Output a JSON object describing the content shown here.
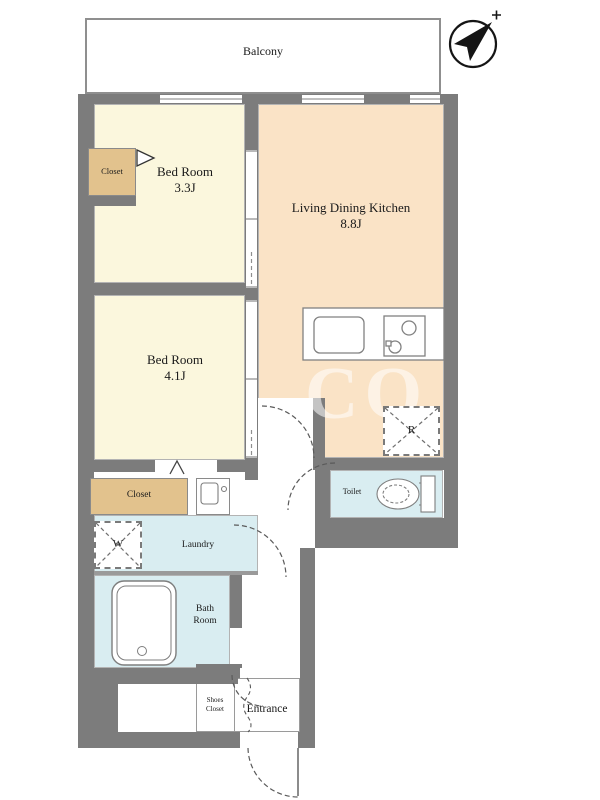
{
  "balcony": {
    "label": "Balcony"
  },
  "compass": {
    "meaning": "north-arrow pointing upper-right"
  },
  "rooms": {
    "bedroom1": {
      "name": "Bed Room",
      "size": "3.3J"
    },
    "ldk": {
      "name": "Living Dining Kitchen",
      "size": "8.8J"
    },
    "bedroom2": {
      "name": "Bed Room",
      "size": "4.1J"
    },
    "closet1": {
      "label": "Closet"
    },
    "closet2": {
      "label": "Closet"
    },
    "laundry": {
      "label": "Laundry"
    },
    "toilet": {
      "label": "Toilet"
    },
    "bathroom": {
      "line1": "Bath",
      "line2": "Room"
    },
    "shoes_closet": {
      "line1": "Shoes",
      "line2": "Closet"
    },
    "entrance": {
      "label": "Entrance"
    }
  },
  "appliances": {
    "washer_label": "W",
    "refrigerator_label": "R"
  },
  "watermark": {
    "text": "CO"
  },
  "colors": {
    "wall": "#7c7c7c",
    "bedroom_fill": "#fbf7dd",
    "ldk_fill": "#fae3c6",
    "closet_fill": "#e2c28d",
    "wet_area_fill": "#d9edf1"
  }
}
